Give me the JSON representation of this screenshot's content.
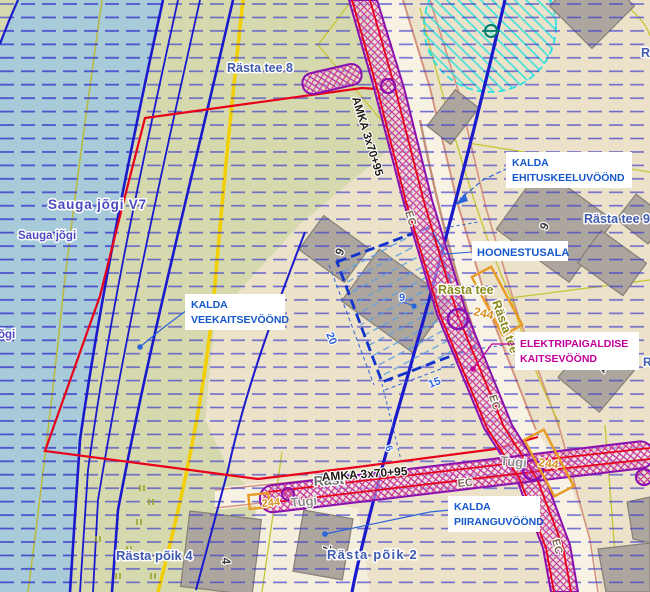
{
  "map_labels": {
    "water": {
      "river_parcel": "Sauga jõgi V7",
      "river": "Sauga jõgi",
      "river_clipped": "õgi"
    },
    "addresses": {
      "rasta_tee_8": "Rästa tee 8",
      "rasta_tee_9": "Rästa tee 9",
      "rasta_tee_6": "Rästa tee 6",
      "rasta_poik_4": "Rästa põik 4",
      "rasta_poik_2": "Rästa põik 2",
      "clipped_right_top": "Rä",
      "clipped_right_mid": "R"
    },
    "roads": {
      "rasta_tee": "Rästa tee",
      "rasta_clipped": "Räst"
    },
    "utilities": {
      "cable_type": "AMKA 3x70+95",
      "cable_code": "EC",
      "pole_number": "244",
      "pole_name": "Tugi"
    },
    "callouts": {
      "ehituskeeluvoond": {
        "line1": "KALDA",
        "line2": "EHITUSKEELUVÖÖND"
      },
      "hoonestusala": {
        "line1": "HOONESTUSALA"
      },
      "veekaitsevoond": {
        "line1": "KALDA",
        "line2": "VEEKAITSEVÖÖND"
      },
      "elektripaigaldise": {
        "line1": "ELEKTRIPAIGALDISE",
        "line2": "KAITSEVÖÖND"
      },
      "piiranguvoond": {
        "line1": "KALDA",
        "line2": "PIIRANGUVÖÖND"
      }
    },
    "dimensions": {
      "side_long": "20",
      "side_short": "15",
      "offset": "6",
      "annotation": "9"
    },
    "building_numbers": {
      "b9": "9",
      "b6": "6",
      "b1": "1",
      "b4": "4",
      "b7": "7"
    }
  },
  "colors": {
    "water": "#a7cbd9",
    "land_green": "#d6d9ae",
    "land_tan": "#ece2ca",
    "road": "#f7f2e3",
    "building": "#ada69e",
    "hatch_blue": "#3d3ccb",
    "line_blue": "#1a1acc",
    "boundary_red": "#e8001a",
    "corridor_purple": "#8a10b0",
    "cadastral_olive": "#c6c636",
    "road_yellow": "#f2cf00",
    "circle_cyan": "#2adfdf",
    "pole_orange": "#e89b25",
    "callout_blue": "#1557cc",
    "callout_magenta": "#c4009c"
  }
}
